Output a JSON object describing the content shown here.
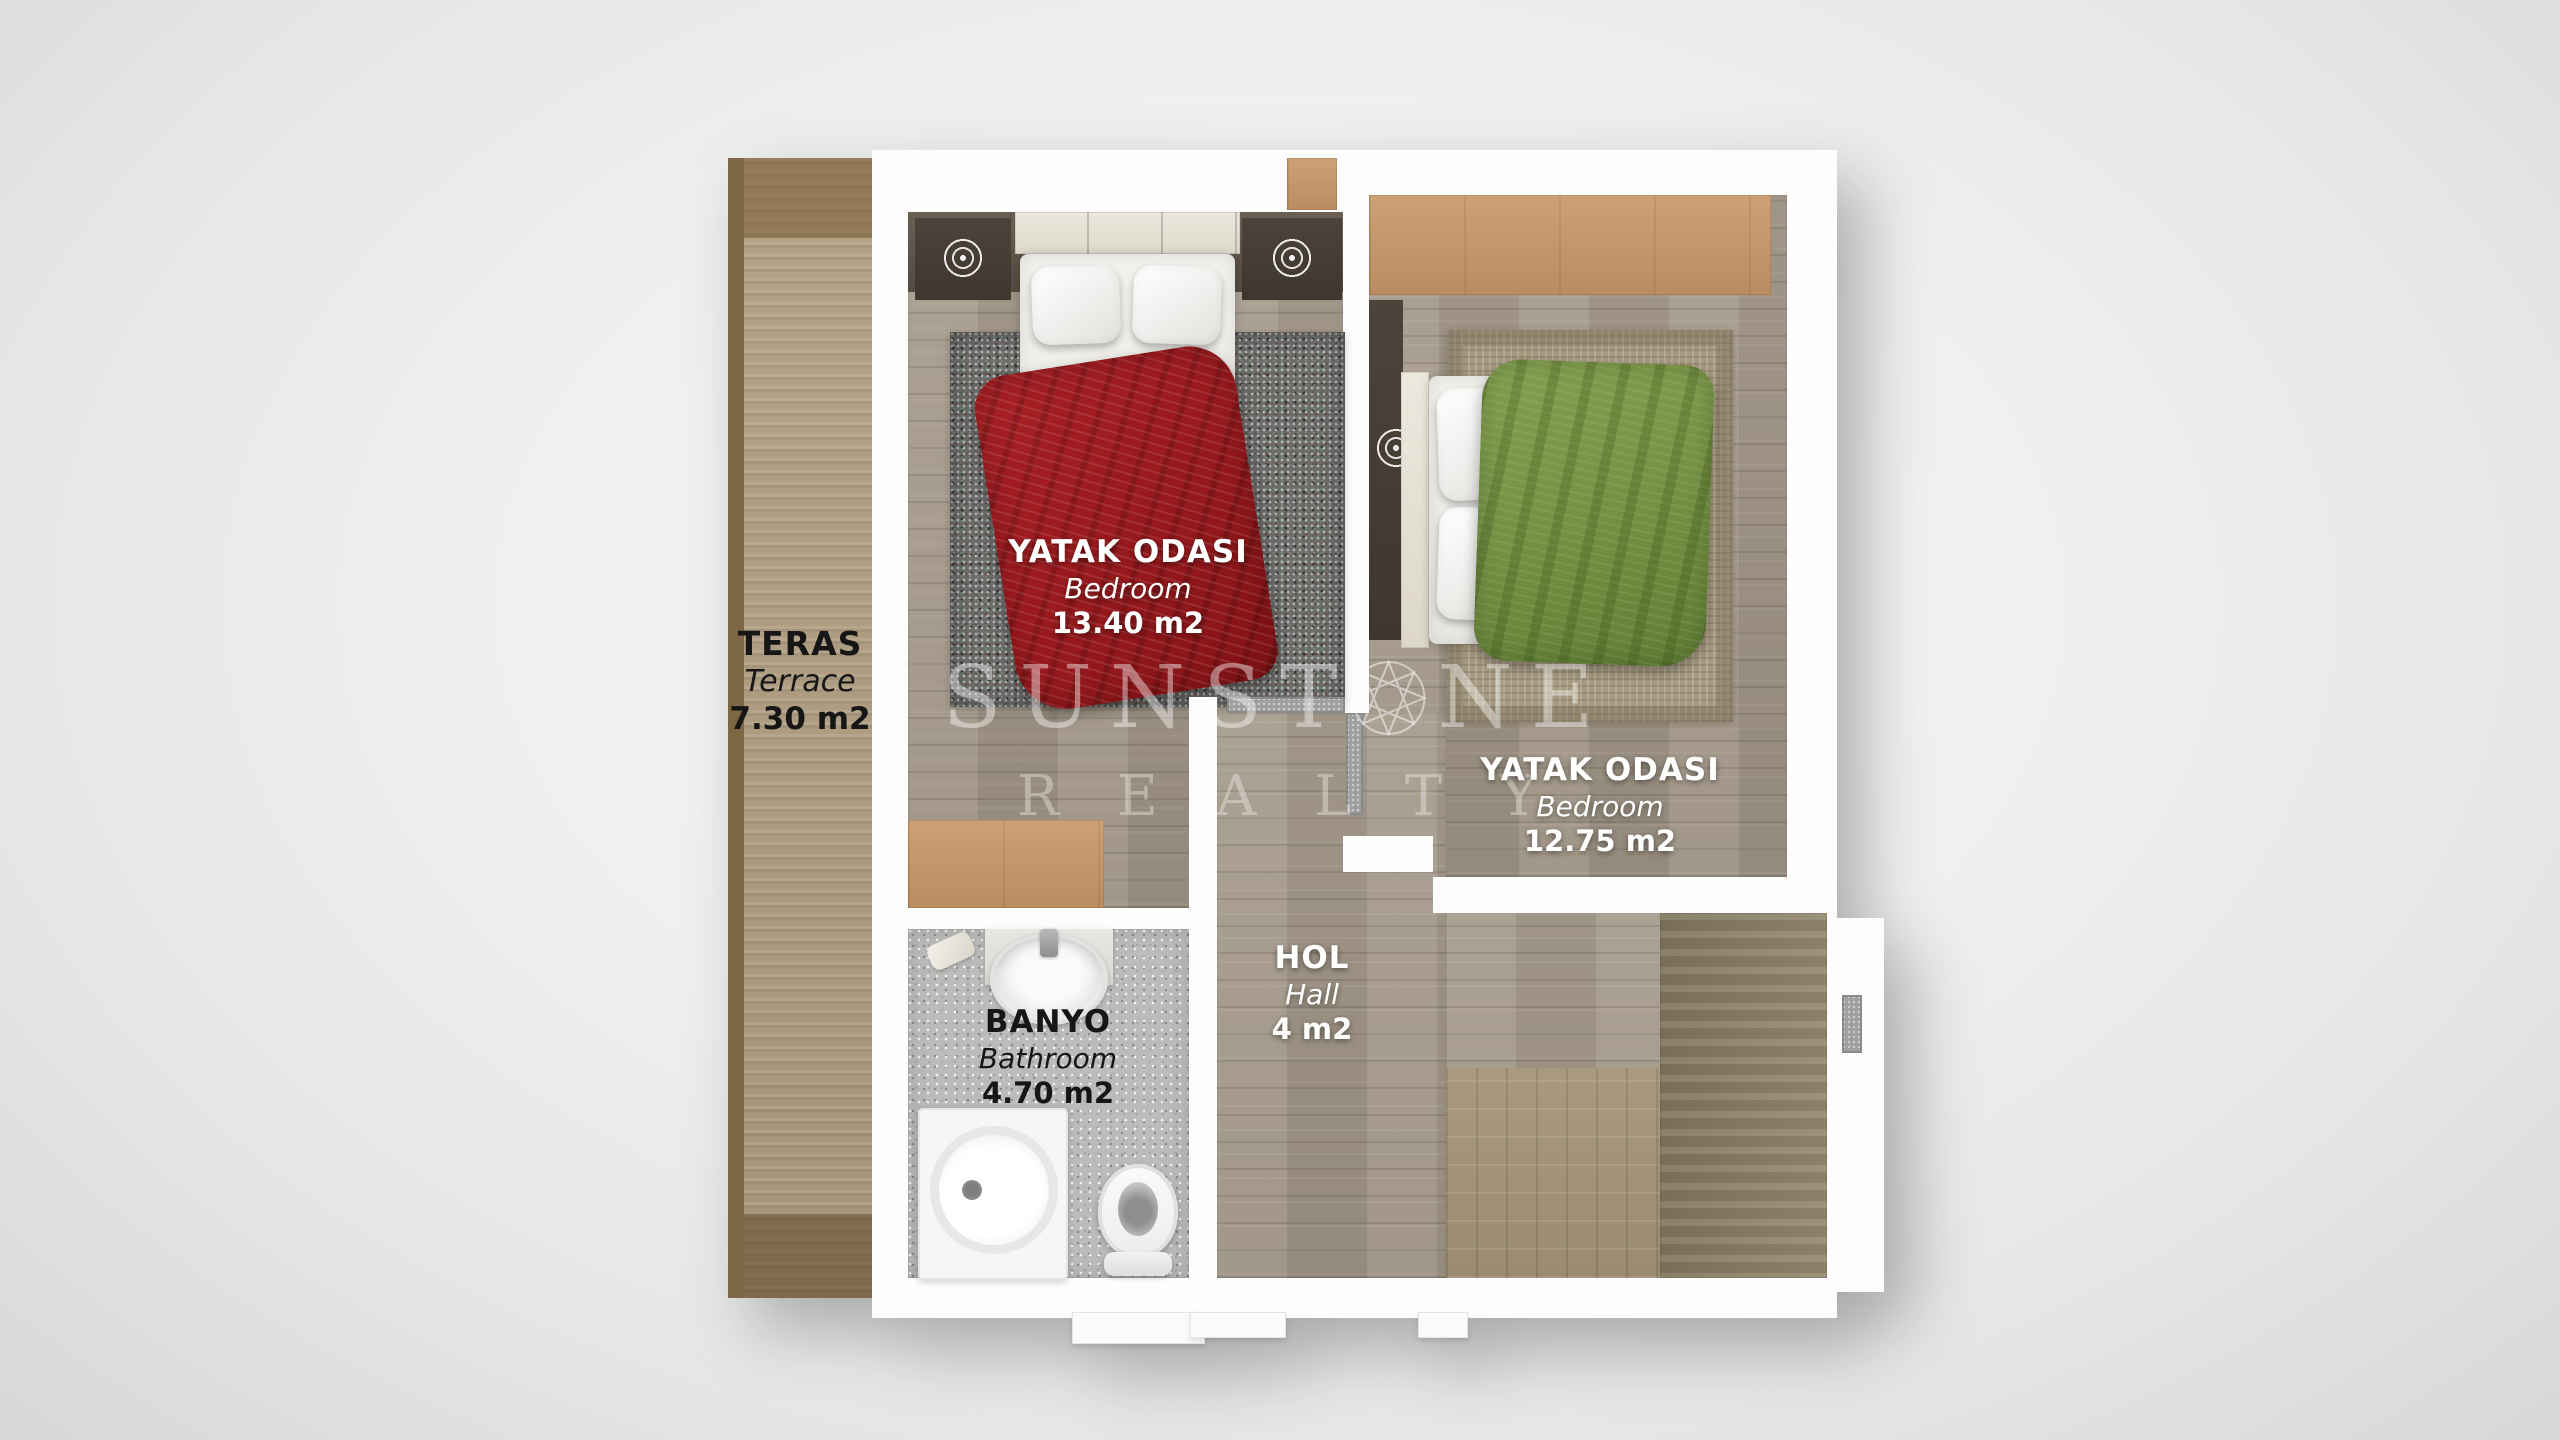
{
  "watermark": {
    "brand_part1": "SUNST",
    "brand_part2": "NE",
    "line2": "REALTY"
  },
  "rooms": {
    "terrace": {
      "name": "TERAS",
      "name_en": "Terrace",
      "area": "7.30 m2"
    },
    "bedroom1": {
      "name": "YATAK ODASI",
      "name_en": "Bedroom",
      "area": "13.40 m2"
    },
    "bedroom2": {
      "name": "YATAK ODASI",
      "name_en": "Bedroom",
      "area": "12.75 m2"
    },
    "hall": {
      "name": "HOL",
      "name_en": "Hall",
      "area": "4 m2"
    },
    "bathroom": {
      "name": "BANYO",
      "name_en": "Bathroom",
      "area": "4.70 m2"
    }
  },
  "colors": {
    "blanket_red": "#9b1a1e",
    "blanket_green": "#759242",
    "terrace_wood": "#b09e80",
    "floor_wood": "#a59a8b",
    "wardrobe_tan": "#c49a6c",
    "wall_white": "#fdfdfd",
    "bathroom_tile": "#bbbbba",
    "background": "#efefef"
  }
}
